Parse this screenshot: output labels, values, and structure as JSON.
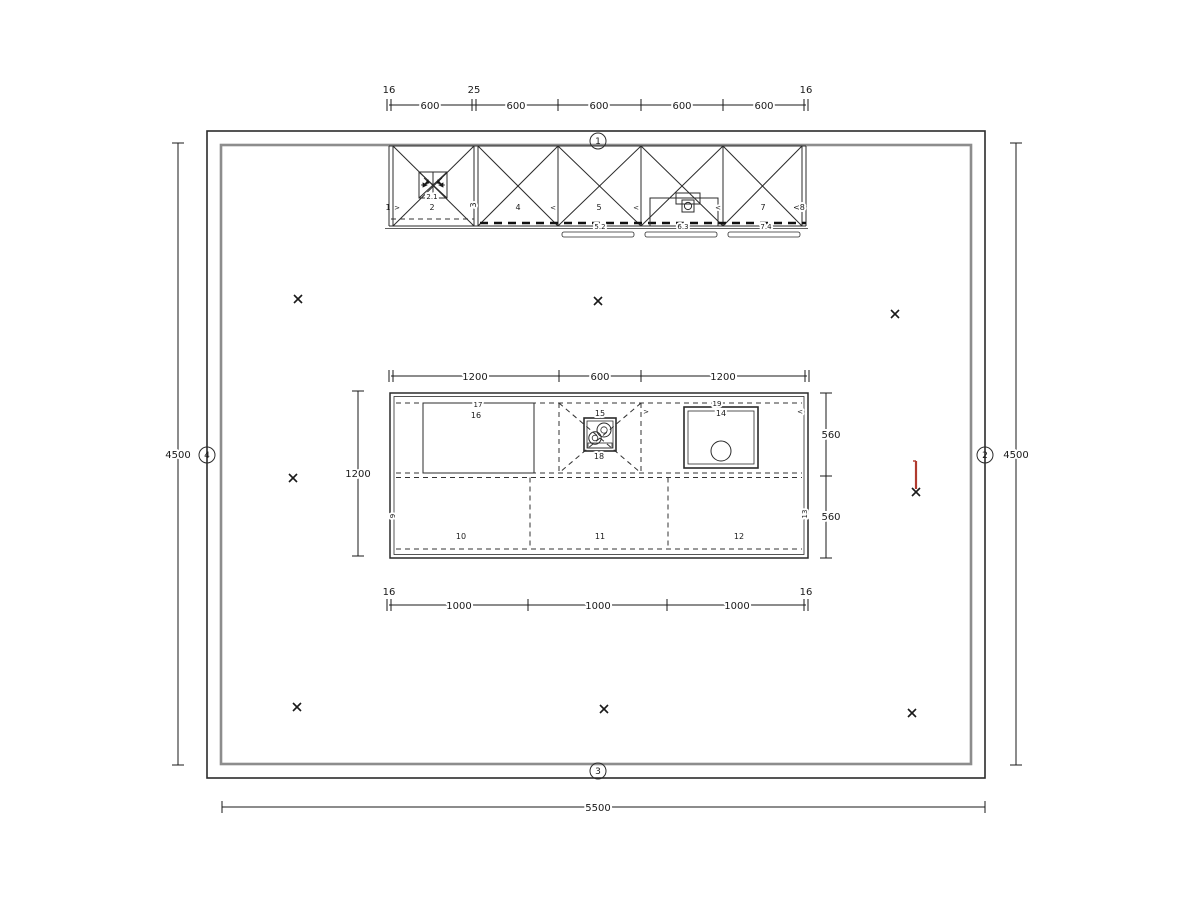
{
  "grid_bubbles": {
    "top": "1",
    "right": "2",
    "bottom": "3",
    "left": "4"
  },
  "room_dims": {
    "left": "4500",
    "right": "4500",
    "bottom": "5500"
  },
  "top_run_dim": {
    "left_end": "16",
    "mid": "25",
    "right_end": "16",
    "segs": [
      "600",
      "600",
      "600",
      "600",
      "600"
    ]
  },
  "island_top_dim": {
    "segs": [
      "1200",
      "600",
      "1200"
    ]
  },
  "island_bottom_dim": {
    "left_end": "16",
    "right_end": "16",
    "segs": [
      "1000",
      "1000",
      "1000"
    ]
  },
  "island_left_dim": "1200",
  "island_right_dim": {
    "upper": "560",
    "lower": "560"
  },
  "wall_cabinets": {
    "c1": "1",
    "c1_arrow": ">",
    "c2": "2",
    "fan": "2.1",
    "c3": "3",
    "c4": "4",
    "a4": "<",
    "c5": "5",
    "a5": "<",
    "a6": "<",
    "c7": "7",
    "right_end": "<8",
    "handles": [
      "5.2",
      "6.3",
      "7.4"
    ]
  },
  "island": {
    "board_line": "17",
    "board": "16",
    "cooktop_line": "15",
    "cooktop": "18",
    "sink_line": "19",
    "sink": "14",
    "left_end": "9",
    "right_end": "13",
    "cells": [
      "10",
      "11",
      "12"
    ],
    "arrow_in": ">",
    "arrow_out": "<"
  },
  "colors": {
    "line": "#2b2b2b",
    "wall_gray": "#8d8d8d",
    "marker_red": "#b03a2e"
  }
}
